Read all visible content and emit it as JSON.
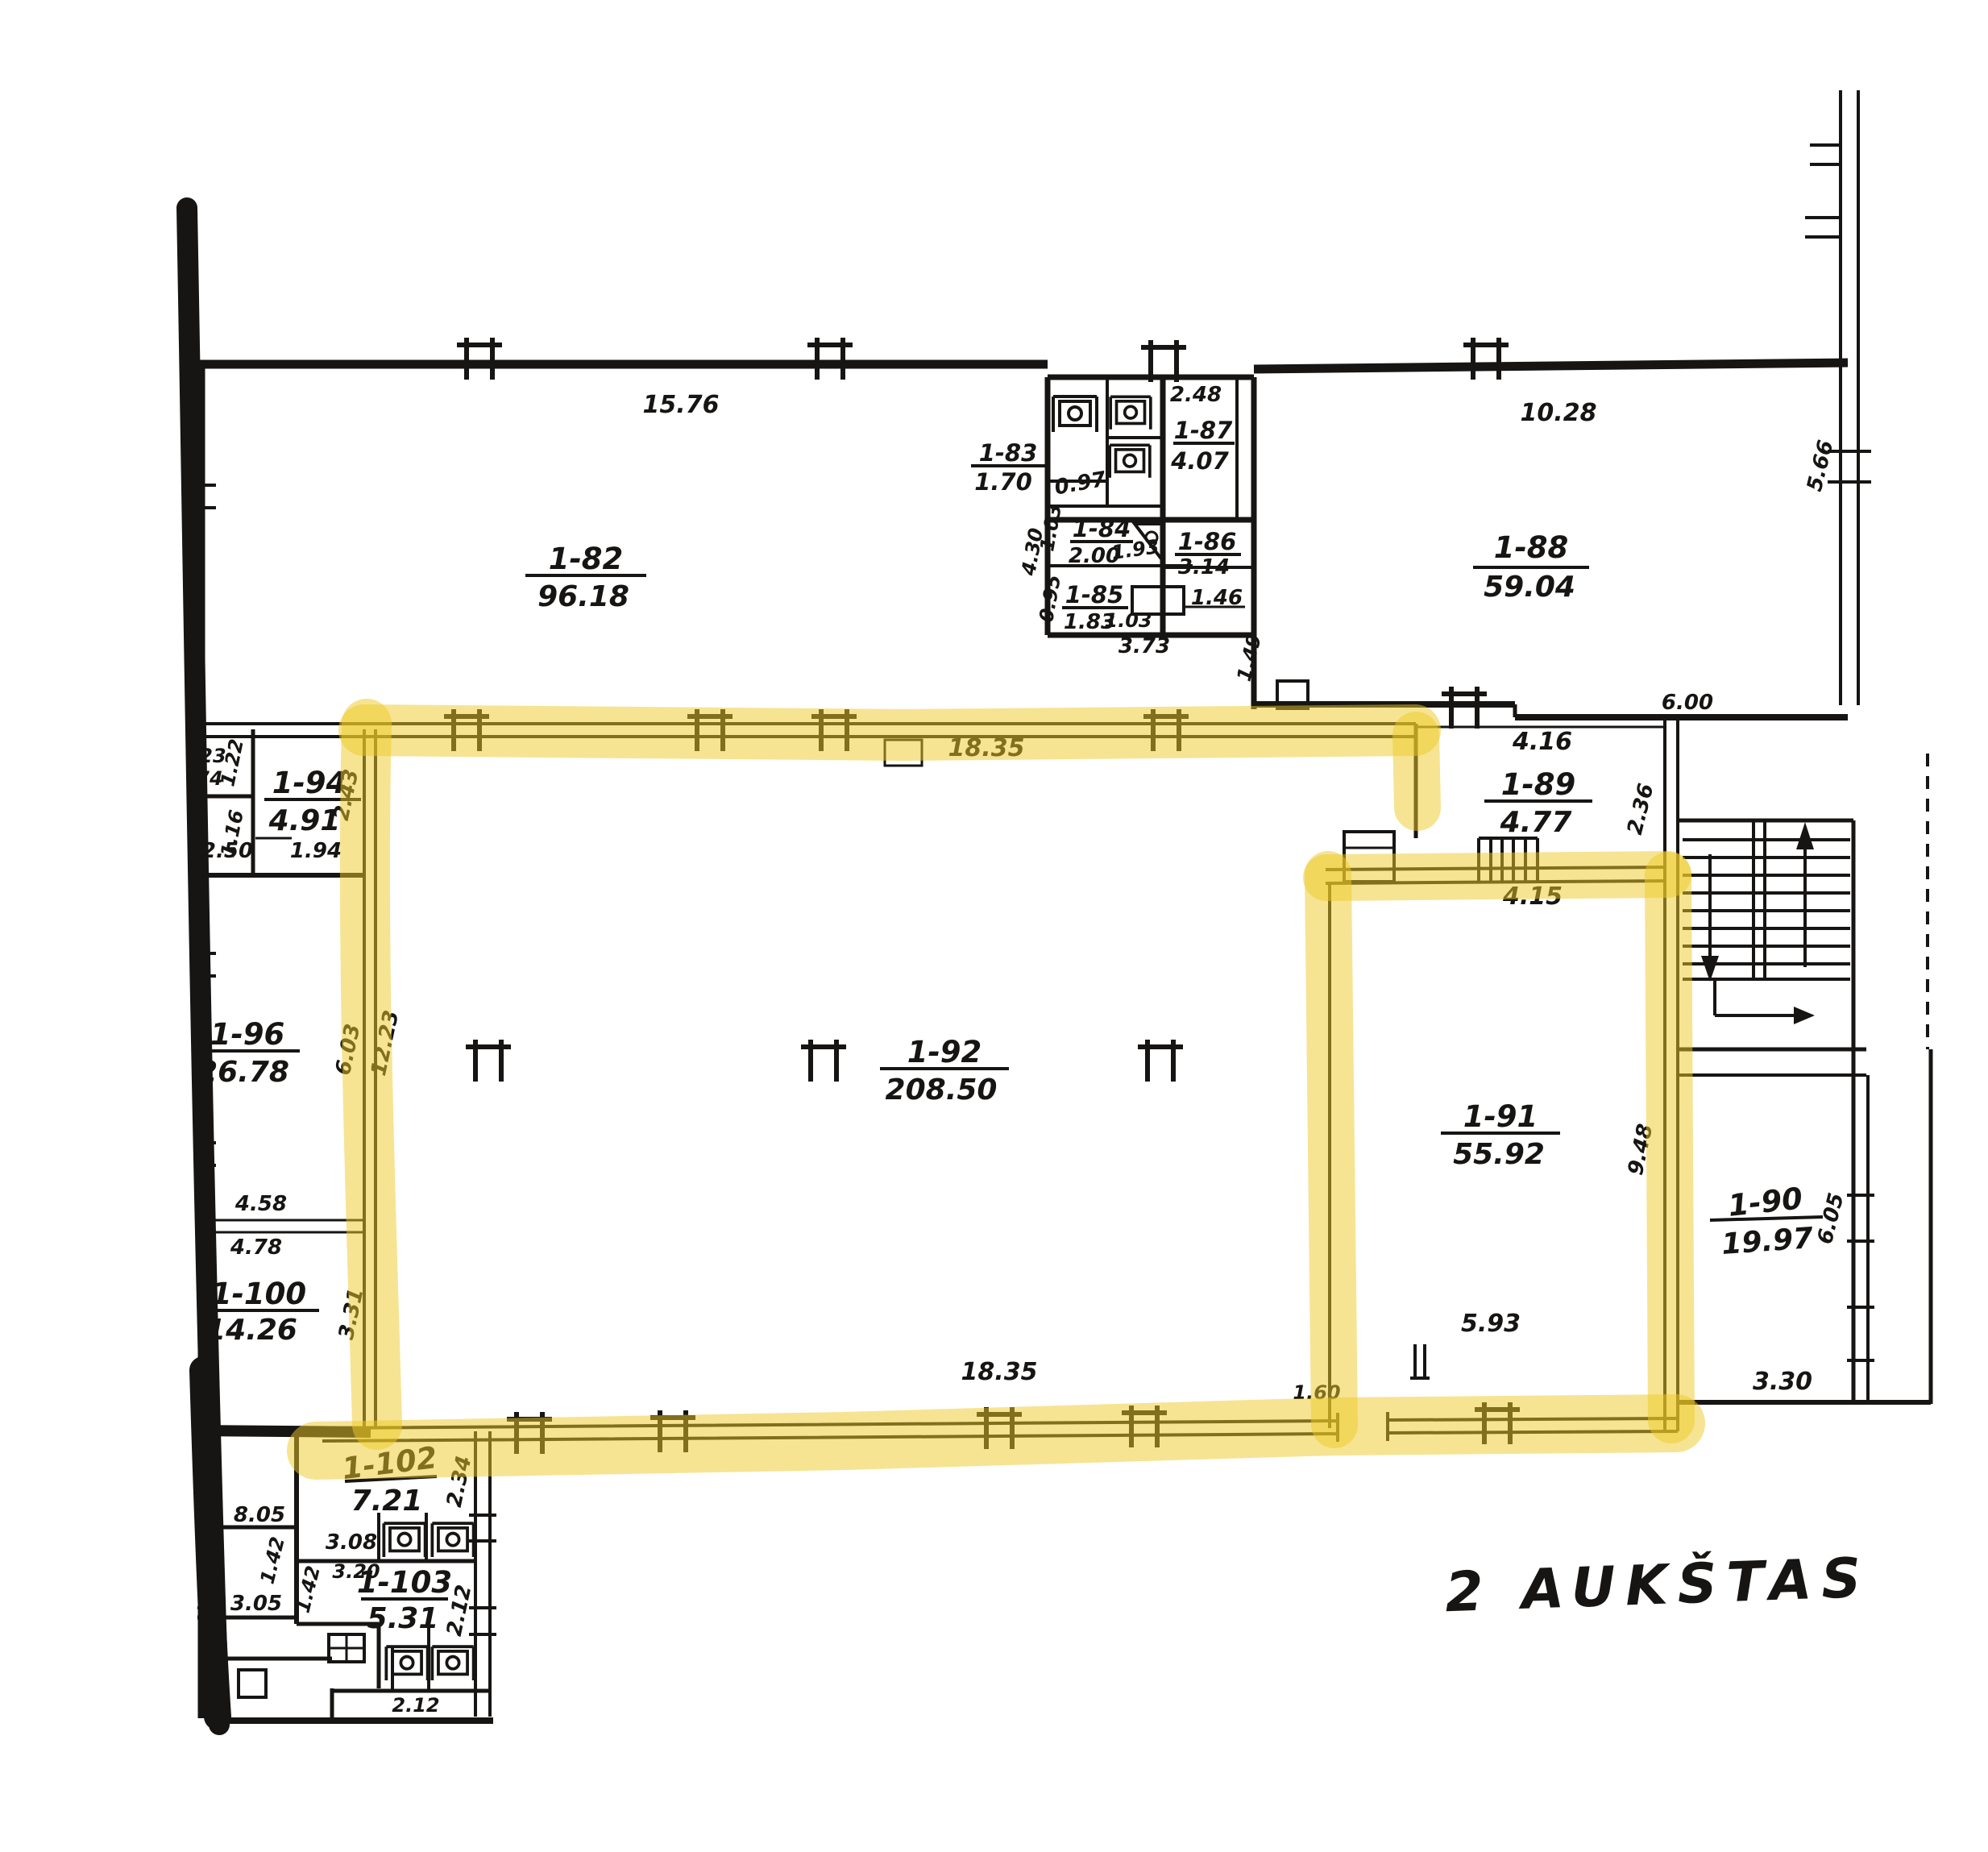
{
  "title": "2 AUKŠTAS",
  "colors": {
    "ink": "#171513",
    "highlighter": "#edc928",
    "paper": "#ffffff"
  },
  "rooms": {
    "r82": {
      "num": "1-82",
      "area": "96.18"
    },
    "r83": {
      "num": "1-83",
      "area": "1.70"
    },
    "r84": {
      "num": "1-84",
      "area": "2.00"
    },
    "r85": {
      "num": "1-85",
      "area": "1.83"
    },
    "r86": {
      "num": "1-86",
      "area": "3.14"
    },
    "r87": {
      "num": "1-87",
      "area": "4.07"
    },
    "r88": {
      "num": "1-88",
      "area": "59.04"
    },
    "r89": {
      "num": "1-89",
      "area": "4.77"
    },
    "r90": {
      "num": "1-90",
      "area": "19.97"
    },
    "r91": {
      "num": "1-91",
      "area": "55.92"
    },
    "r92": {
      "num": "1-92",
      "area": "208.50"
    },
    "r94": {
      "num": "1-94",
      "area": "4.91"
    },
    "r96": {
      "num": "1-96",
      "area": "26.78"
    },
    "r100": {
      "num": "1-100",
      "area": "14.26"
    },
    "r102": {
      "num": "1-102",
      "area": "7.21"
    },
    "r103": {
      "num": "1-103",
      "area": "5.31"
    }
  },
  "dims": {
    "w15_76": "15.76",
    "w2_48": "2.48",
    "w10_28": "10.28",
    "w5_66": "5.66",
    "w0_97": "0.97",
    "w4_30": "4.30",
    "w1_03a": "1.03",
    "w1_93": "1.93",
    "w1_03b": "1.03",
    "w0_95": "0.95",
    "w1_46": "1.46",
    "w3_73": "3.73",
    "w1_49": "1.49",
    "w6_00": "6.00",
    "w4_16": "4.16",
    "w2_36": "2.36",
    "w4_15": "4.15",
    "w18_35t": "18.35",
    "w18_35b": "18.35",
    "w1_60": "1.60",
    "w9_48": "9.48",
    "w5_93": "5.93",
    "w6_05": "6.05",
    "w3_30": "3.30",
    "w6_03": "6.03",
    "w12_23": "12.23",
    "w3_31": "3.31",
    "w4_58": "4.58",
    "w4_78": "4.78",
    "w1_94": "1.94",
    "w2_43": "2.43",
    "w1_22": "1.22",
    "w1_16": "1.16",
    "w2_50": "2.50",
    "frag23": "23",
    "frag74": "74",
    "w8_05": "8.05",
    "w3_08": "3.08",
    "w1_42a": "1.42",
    "w1_42b": "1.42",
    "w3_20": "3.20",
    "w3_05": "3.05",
    "w2_34": "2.34",
    "w2_12a": "2.12",
    "w2_12b": "2.12"
  }
}
